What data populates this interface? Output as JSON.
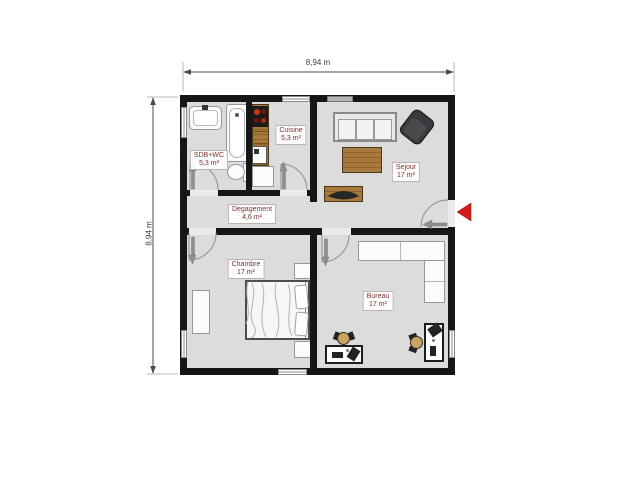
{
  "plan": {
    "dimension_top": "8,94 m",
    "dimension_left": "8,94 m",
    "rooms": {
      "sdb": {
        "name": "SDB+WC",
        "area": "5,3 m²"
      },
      "cuisine": {
        "name": "Cuisine",
        "area": "5,3 m²"
      },
      "sejour": {
        "name": "Sejour",
        "area": "17 m²"
      },
      "degagement": {
        "name": "Degagement",
        "area": "4,6 m²"
      },
      "chambre": {
        "name": "Chambre",
        "area": "17 m²"
      },
      "bureau": {
        "name": "Bureau",
        "area": "17 m²"
      }
    },
    "icons": {
      "entrance_arrow": "red-left-triangle",
      "door_swing_arrow": "gray-arrow"
    },
    "colors": {
      "wall": "#161616",
      "floor": "#dcdcdc",
      "wood": "#a8783c",
      "entrance_red": "#d41c1c",
      "label_text": "#7c332f",
      "stove_burner_red": "#d03012"
    }
  }
}
